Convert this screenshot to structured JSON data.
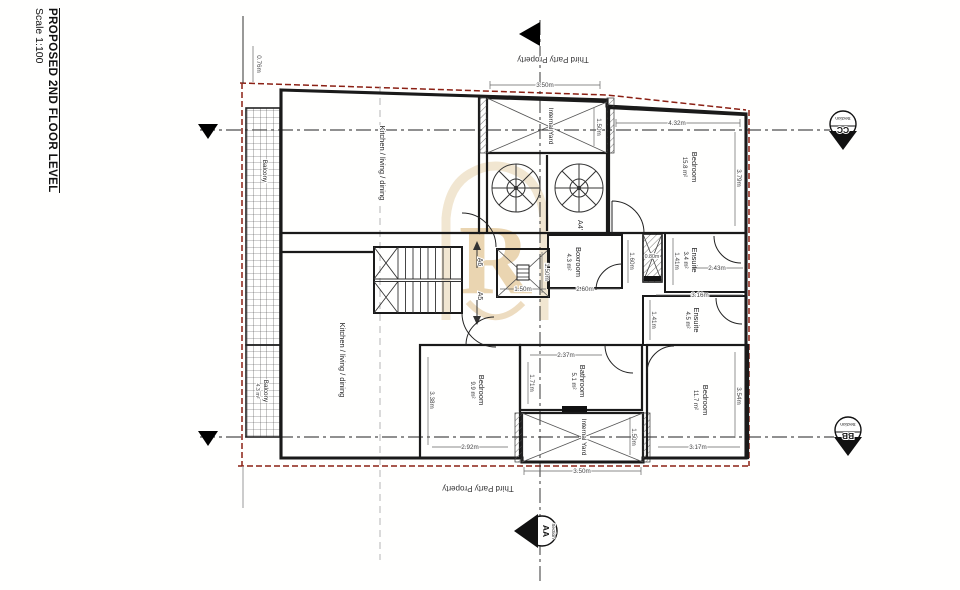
{
  "title": {
    "main": "PROPOSED 2ND FLOOR LEVEL",
    "scale": "Scale 1:100"
  },
  "boundary": {
    "top_label": "Third Party Property",
    "bottom_label": "Third Party Property"
  },
  "watermark": {
    "letter": "R"
  },
  "markers": {
    "aa": {
      "label": "AA",
      "sub": "Section"
    },
    "bb": {
      "label": "BB",
      "sub": "Section"
    },
    "cc": {
      "label": "CC",
      "sub": "Section"
    }
  },
  "stair_refs": {
    "a6": "A6",
    "a5": "A5",
    "a4": "A4'"
  },
  "rooms": {
    "kitchen_upper": {
      "name": "Kitchen / living / dining"
    },
    "kitchen_lower": {
      "name": "Kitchen / living / dining"
    },
    "bedroom_top_right": {
      "name": "Bedroom",
      "area": "15.8 m²"
    },
    "bedroom_bottom_left": {
      "name": "Bedroom",
      "area": "9.9 m²"
    },
    "bedroom_bottom_right": {
      "name": "Bedroom",
      "area": "11.7 m²"
    },
    "boxroom": {
      "name": "Boxroom",
      "area": "4.3 m²"
    },
    "ensuite_upper": {
      "name": "Ensuite",
      "area": "3.4 m²"
    },
    "ensuite_lower": {
      "name": "Ensuite",
      "area": "4.5 m²"
    },
    "bathroom": {
      "name": "Bathroom",
      "area": "5.1 m²"
    },
    "yard_top": {
      "name": "Internal Yard"
    },
    "yard_bottom": {
      "name": "Internal Yard"
    },
    "balcony_upper": {
      "name": "Balcony"
    },
    "balcony_lower": {
      "name": "Balcony",
      "area": "4.3 m²"
    }
  },
  "dimensions": {
    "d_076": "0.76m",
    "d_350_top": "3.50m",
    "d_150_yard_top": "1.50m",
    "d_432": "4.32m",
    "d_379": "3.79m",
    "d_160": "1.60m",
    "d_260": "2.60m",
    "d_080": "0.80m",
    "d_141_ensuite_upper": "1.41m",
    "d_243": "2.43m",
    "d_316": "3.16m",
    "d_141_ensuite_lower": "1.41m",
    "d_150_lift_w": "1.50m",
    "d_150_lift_h": "1.50m",
    "d_237": "2.37m",
    "d_171": "1.71m",
    "d_292": "2.92m",
    "d_338": "3.38m",
    "d_317": "3.17m",
    "d_354": "3.54m",
    "d_150_yard_bottom": "1.50m",
    "d_350_bottom": "3.50m"
  },
  "colors": {
    "boundary_red": "#8B2014",
    "wall": "#1a1a1a",
    "watermark_tan": "#E6D2AC"
  }
}
